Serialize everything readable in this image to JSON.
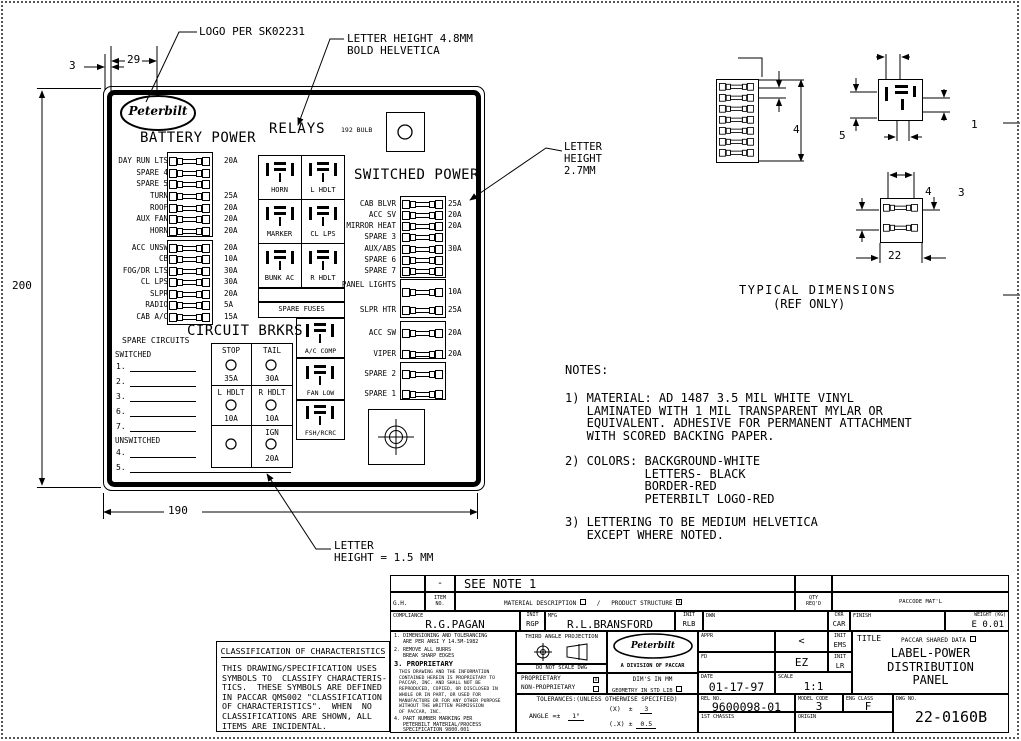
{
  "panel": {
    "logo_text": "Peterbilt",
    "battery_header": "BATTERY POWER",
    "relays_header": "RELAYS",
    "bulb_label": "192 BULB",
    "switched_header": "SWITCHED POWER",
    "circuit_header": "CIRCUIT BRKRS",
    "battery_fuses_a": [
      {
        "label": "DAY RUN LTS",
        "amp": "20A"
      },
      {
        "label": "SPARE 4",
        "amp": ""
      },
      {
        "label": "SPARE 5",
        "amp": ""
      },
      {
        "label": "TURN",
        "amp": "25A"
      },
      {
        "label": "ROOF",
        "amp": "20A"
      },
      {
        "label": "AUX FAN",
        "amp": "20A"
      },
      {
        "label": "HORN",
        "amp": "20A"
      }
    ],
    "battery_fuses_b": [
      {
        "label": "ACC UNSW",
        "amp": "20A"
      },
      {
        "label": "CB",
        "amp": "10A"
      },
      {
        "label": "FOG/DR LTS",
        "amp": "30A"
      },
      {
        "label": "CL LPS",
        "amp": "30A"
      },
      {
        "label": "SLPR",
        "amp": "20A"
      },
      {
        "label": "RADIO",
        "amp": "5A"
      },
      {
        "label": "CAB A/C",
        "amp": "15A"
      }
    ],
    "relays": [
      "HORN",
      "L HDLT",
      "MARKER",
      "CL LPS",
      "BUNK AC",
      "R HDLT"
    ],
    "spare_fuses_label": "SPARE FUSES",
    "switched_fuses_a": [
      {
        "label": "CAB BLVR",
        "amp": "25A"
      },
      {
        "label": "ACC SV",
        "amp": "20A"
      },
      {
        "label": "MIRROR HEAT",
        "amp": "20A"
      },
      {
        "label": "SPARE 3",
        "amp": ""
      },
      {
        "label": "AUX/ABS",
        "amp": "30A"
      },
      {
        "label": "SPARE 6",
        "amp": ""
      },
      {
        "label": "SPARE 7",
        "amp": ""
      }
    ],
    "switched_fuses_b": [
      {
        "label": "PANEL\nLIGHTS",
        "amp": "10A"
      },
      {
        "label": "SLPR HTR",
        "amp": "25A"
      },
      {
        "label": "ACC SW",
        "amp": "20A"
      },
      {
        "label": "VIPER",
        "amp": "20A"
      },
      {
        "label": "SPARE 2",
        "amp": ""
      },
      {
        "label": "SPARE 1",
        "amp": ""
      }
    ],
    "side_relays": [
      "A/C COMP",
      "FAN LOW",
      "FSH/RCRC"
    ],
    "spare_circuits": {
      "header": "SPARE CIRCUITS",
      "switched": "SWITCHED",
      "unswitched": "UNSWITCHED",
      "s1": "1.",
      "s2": "2.",
      "s3": "3.",
      "s4": "6.",
      "s5": "7.",
      "u1": "4.",
      "u2": "5."
    },
    "breakers": {
      "r1c1": "STOP",
      "r1c2": "TAIL",
      "a1c1": "35A",
      "a1c2": "30A",
      "r2c1": "L HDLT",
      "r2c2": "R HDLT",
      "a2c1": "10A",
      "a2c2": "10A",
      "r3c2": "IGN",
      "a3c2": "20A"
    }
  },
  "dims": {
    "d3": "3",
    "d29": "29",
    "d200": "200",
    "d190": "190"
  },
  "callouts": {
    "logo_note": "LOGO PER SK02231",
    "lh48": "LETTER HEIGHT 4.8MM\nBOLD HELVETICA",
    "lh27": "LETTER\nHEIGHT\n2.7MM",
    "lh15": "LETTER\nHEIGHT = 1.5 MM"
  },
  "typical": {
    "caption1": "TYPICAL DIMENSIONS",
    "caption2": "(REF ONLY)",
    "strip_h": "4",
    "relay_left": "5",
    "relay_right": "1",
    "block_top": "4",
    "block_right": "3",
    "block_bottom": "22"
  },
  "notes": {
    "header": "NOTES:",
    "n1": "1) MATERIAL: AD 1487 3.5 MIL WHITE VINYL\n   LAMINATED WITH 1 MIL TRANSPARENT MYLAR OR\n   EQUIVALENT. ADHESIVE FOR PERMANENT ATTACHMENT\n   WITH SCORED BACKING PAPER.",
    "n2": "2) COLORS: BACKGROUND-WHITE\n           LETTERS- BLACK\n           BORDER-RED\n           PETERBILT LOGO-RED",
    "n3": "3) LETTERING TO BE MEDIUM HELVETICA\n   EXCEPT WHERE NOTED."
  },
  "classification": {
    "title": "CLASSIFICATION OF CHARACTERISTICS",
    "body": "THIS DRAWING/SPECIFICATION USES\nSYMBOLS TO  CLASSIFY CHARACTERIS-\nTICS.  THESE SYMBOLS ARE DEFINED\nIN PACCAR QMS002 \"CLASSIFICATION\nOF CHARACTERISTICS\".  WHEN  NO\nCLASSIFICATIONS ARE SHOWN, ALL\nITEMS ARE INCIDENTAL."
  },
  "tb": {
    "dash": "-",
    "see_note": "SEE NOTE 1",
    "gh": "G.H.",
    "item_no": "ITEM\nNO.",
    "material_desc": "MATERIAL DESCRIPTION",
    "mat_check": "",
    "slash": "/",
    "product_structure": "PRODUCT STRUCTURE",
    "ps_check": "X",
    "qty": "QTY\nREQ'D",
    "paccode": "PACCODE MAT'L",
    "compliance": "COMPLIANCE",
    "compliance_name": "R.G.PAGAN",
    "init": "INIT",
    "init_rgp": "RGP",
    "mfg": "MFG",
    "mfg_name": "R.L.BRANSFORD",
    "init_rlb": "RLB",
    "dwn": "DWN",
    "ckr": "CKR",
    "ckr_val": "CAR",
    "finish": "FINISH",
    "weight_label": "WEIGHT (KG)",
    "weight_val": "E 0.01",
    "note1": "1. DIMENSIONING AND TOLERANCING\n   ARE PER ANSI Y 14.5M-1982",
    "note2": "2. REMOVE ALL BURRS\n   BREAK SHARP EDGES",
    "note3_head": "3. PROPRIETARY",
    "note3_body": "THIS DRAWING AND THE INFORMATION\nCONTAINED HEREIN IS PROPRIETARY TO\nPACCAR, INC. AND SHALL NOT BE\nREPRODUCED, COPIED, OR DISCLOSED IN\nWHOLE OR IN PART, OR USED FOR\nMANUFACTURE OR FOR ANY OTHER PURPOSE\nWITHOUT THE WRITTEN PERMISSION\nOF PACCAR, INC.",
    "note4": "4. PART NUMBER MARKING PER\n   PETERBILT MATERIAL/PROCESS\n   SPECIFICATION 9800.001",
    "third_angle": "THIRD ANGLE PROJECTION",
    "dns": "DO NOT SCALE DWG",
    "prop": "PROPRIETARY",
    "prop_check": "X",
    "nonprop": "NON-PROPRIETARY",
    "nonprop_check": "",
    "logo_text": "Peterbilt",
    "division": "A DIVISION OF PACCAR",
    "dims_mm": "DIM'S IN MM",
    "geometry": "GEOMETRY IN STD LIB",
    "geometry_check": "",
    "tol_header": "TOLERANCES:(UNLESS OTHERWISE SPECIFIED)",
    "tol_angle_label": "ANGLE =±",
    "tol_angle_val": "1°",
    "tol_x_label": "(X)  ±",
    "tol_x_val": "3",
    "tol_dx_label": "(.X) ±",
    "tol_dx_val": "0.5",
    "appr": "APPR",
    "appr_sig": "<",
    "fd": "FD",
    "fd_sig": "EZ",
    "init_ems": "EMS",
    "init_lr": "LR",
    "date_label": "DATE",
    "date_val": "01-17-97",
    "scale_label": "SCALE",
    "scale_val": "1:1",
    "title_label": "TITLE",
    "shared": "PACCAR SHARED DATA",
    "shared_check": "",
    "title_text": "LABEL-POWER\nDISTRIBUTION\nPANEL",
    "rel_label": "REL NO.",
    "rel_val": "9600098-01",
    "chassis": "1ST CHASSIS",
    "model_label": "MODEL CODE",
    "model_val": "3",
    "eng_label": "ENG CLASS",
    "eng_val": "F",
    "dwg_label": "DWG NO.",
    "dwg_val": "22-0160B",
    "origin": "ORIGIN"
  }
}
